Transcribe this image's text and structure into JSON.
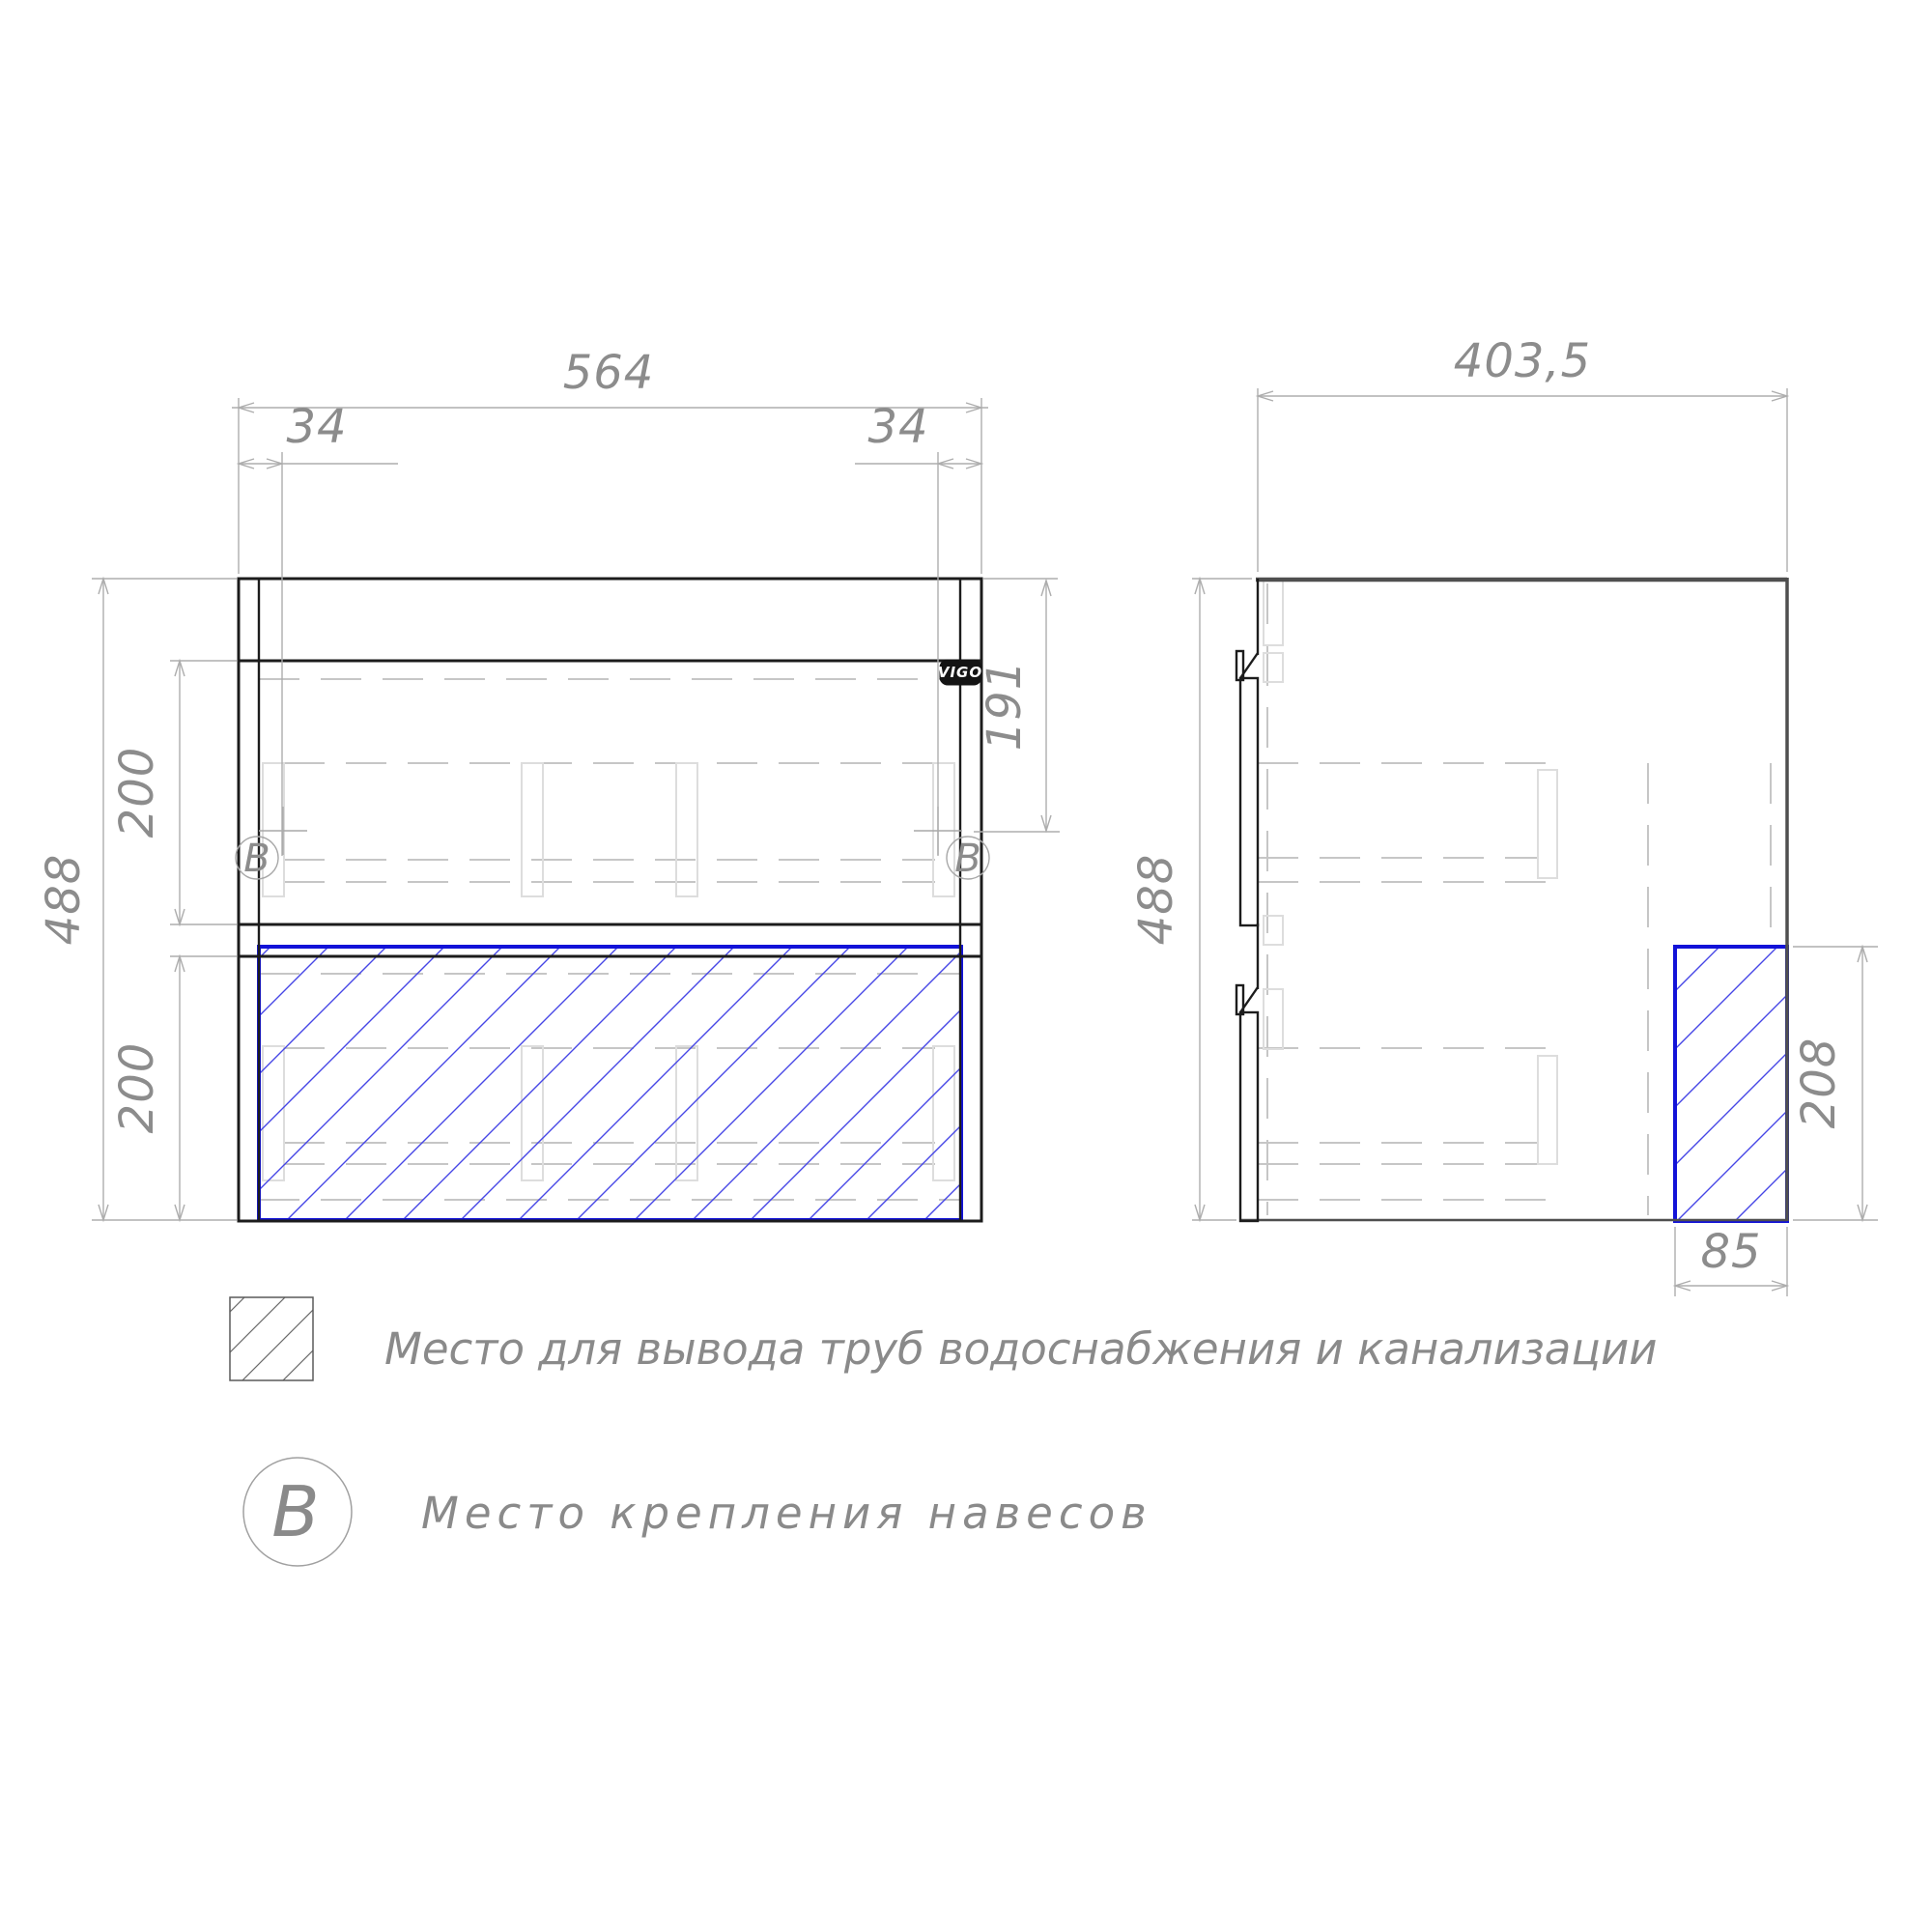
{
  "front_view": {
    "width": "564",
    "offset_left": "34",
    "offset_right": "34",
    "height": "488",
    "upper_drawer_height": "200",
    "lower_drawer_height": "200",
    "mount_point_drop": "191",
    "mount_marker_left": "B",
    "mount_marker_right": "B",
    "brand_badge": "VIGO"
  },
  "side_view": {
    "depth": "403,5",
    "height": "488",
    "pipe_zone_height": "208",
    "pipe_zone_depth": "85"
  },
  "legend": {
    "pipe_zone_label": "Место для вывода труб водоснабжения и канализации",
    "mount_symbol": "B",
    "mount_label": "Место крепления навесов"
  },
  "colors": {
    "outline_black": "#1c1c1c",
    "outline_dark_gray": "#4f4f4f",
    "dimension_gray": "#8c8c8c",
    "hidden_line_gray": "#c6c6c6",
    "pipe_zone_blue": "#1212d8",
    "pipe_hatch_blue": "#4646e6"
  }
}
